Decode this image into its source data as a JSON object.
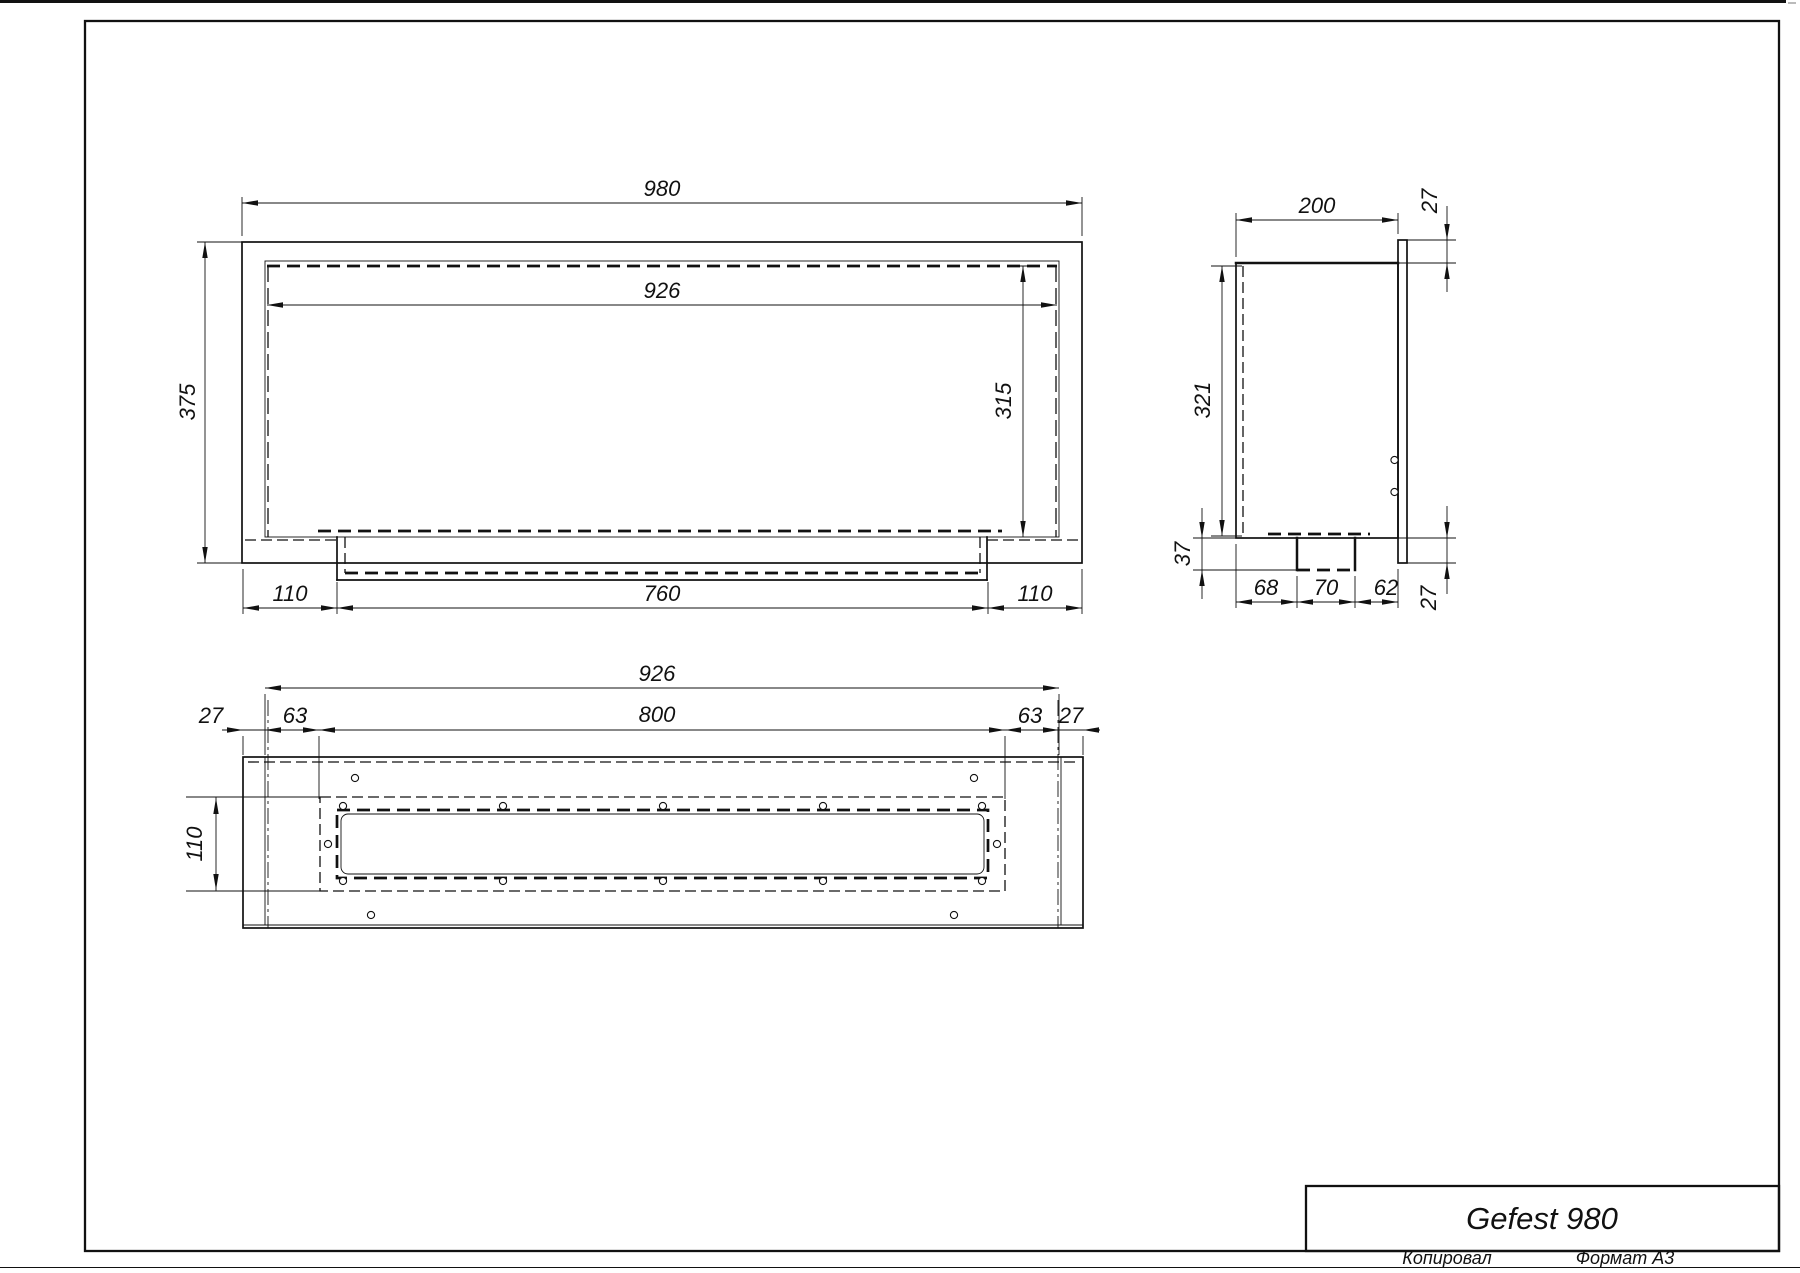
{
  "title_block": {
    "model": "Gefest 980"
  },
  "footer": {
    "copied": "Копировал",
    "format": "Формат А3"
  },
  "dims": {
    "front": {
      "width_outer": "980",
      "width_opening": "926",
      "height_outer": "375",
      "height_opening": "315",
      "tray_left": "110",
      "tray_width": "760",
      "tray_right": "110"
    },
    "side": {
      "depth": "200",
      "flange_top": "27",
      "height_opening": "321",
      "tray_depth": "37",
      "seg_left": "68",
      "seg_center": "70",
      "seg_right": "62",
      "flange_bottom": "27"
    },
    "bottom": {
      "width_opening": "926",
      "margin_left": "27",
      "inset_left": "63",
      "slot_length": "800",
      "inset_right": "63",
      "margin_right": "27",
      "slot_width": "110"
    }
  }
}
